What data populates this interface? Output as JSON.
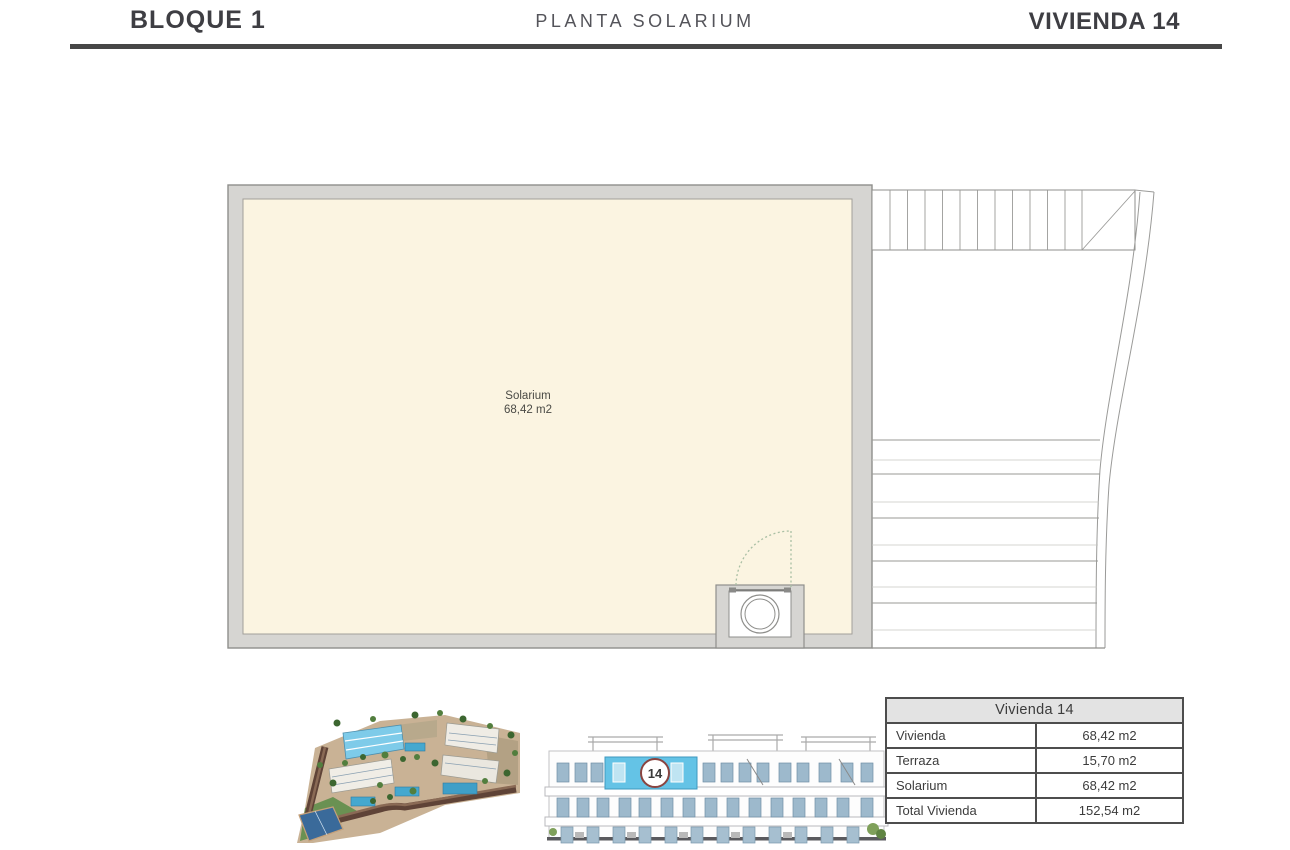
{
  "header": {
    "block_title": "BLOQUE 1",
    "plan_title": "PLANTA SOLARIUM",
    "unit_title": "VIVIENDA 14"
  },
  "plan": {
    "room_name": "Solarium",
    "room_area": "68,42 m2"
  },
  "elevation": {
    "unit_badge": "14"
  },
  "table": {
    "title": "Vivienda 14",
    "rows": [
      {
        "label": "Vivienda",
        "value": "68,42 m2"
      },
      {
        "label": "Terraza",
        "value": "15,70 m2"
      },
      {
        "label": "Solarium",
        "value": "68,42 m2"
      },
      {
        "label": "Total Vivienda",
        "value": "152,54 m2"
      }
    ]
  },
  "colors": {
    "wall_gray": "#d6d5d2",
    "floor_cream": "#fbf4e1",
    "highlight_blue": "#6ec5e6",
    "badge_ring_red": "#8a4440",
    "header_text": "#3e3e43",
    "table_border": "#4d4d4d",
    "door_swing_green": "#a9bfa4"
  }
}
